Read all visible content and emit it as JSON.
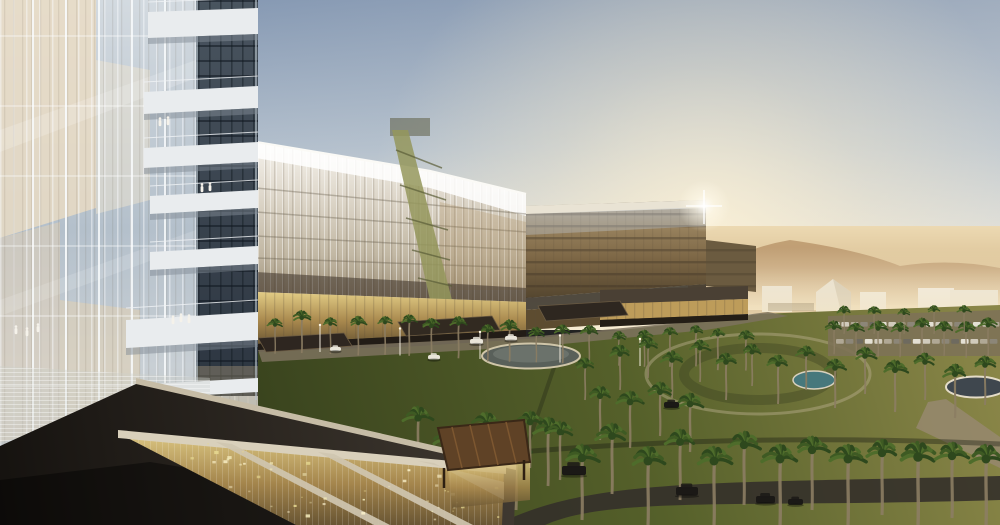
{
  "scene": {
    "type": "architectural-rendering",
    "description": "Aerial dusk rendering of a modern glass hospital campus in a desert: a tall glass tower in the left foreground with people on balconies, a long striped glass slab building, a cantilevered amber glass block catching a sun glint, golden entrance canopies, palm-filled lawns with a circular fountain and ring path, parking rows with cars, sand dunes and white low-rise buildings on the hazy horizon, and a dark roof terrace with a glowing golden skylight in the foreground.",
    "regions": {
      "sky": "gradient dusk sky with warm glow at right",
      "desert": "sand plain with dune hill",
      "complex": "glass tower, striped slab wing, amber cantilevered block, podium canopies",
      "gardens": "lawn, palm trees, circular fountain, ring path, ponds, roads, parking",
      "foreground": "dark roof terrace, golden skylight with concrete beams, timber pergola"
    }
  },
  "palette": {
    "sky_top": "#7E93B0",
    "sky_mid": "#AEBCCB",
    "sky_horizon": "#F1E7D1",
    "sun_glow": "#FFF3D6",
    "desert_light": "#ECD9B2",
    "desert_deep": "#C8A878",
    "dune": "#BC9A70",
    "haze": "#F4E5C4",
    "distant_building": "#ECE5D6",
    "lawn_light": "#8A8648",
    "lawn_mid": "#55602A",
    "lawn_dark": "#333D1B",
    "road_light": "#96886E",
    "road_dark": "#34302A",
    "fountain_water": "#6D746D",
    "pond_teal": "#47787C",
    "pond_dark": "#3F474E",
    "slab_top": "#F5F2EC",
    "slab_base": "#9A8C74",
    "amber_top": "#B5AB99",
    "amber_deep": "#55462F",
    "gold_glass": "#E2CC85",
    "gold_deep": "#6B5734",
    "canopy_dark": "#2E2620",
    "pergola": "#5F4226",
    "terrace_dark": "#15120F",
    "terrace_beam": "#D9D0BB",
    "parapet": "#C6BCA6",
    "tower_glass": "#D3DAE0",
    "tower_cream": "#E8DCC6",
    "tower_core": "#2C3540",
    "balcony_white": "#E9ECEE",
    "mullion_white": "#F8FAFC",
    "palm_trunk": "#8C7D63",
    "palm_green_dark": "#2E481D",
    "palm_green": "#3E5A23",
    "palm_green_light": "#4E6C2B",
    "car_white": "#E9E5D9",
    "car_dark": "#1B1916",
    "figure_white": "#F5F2EA",
    "sparkle": "#F2E9B8"
  }
}
